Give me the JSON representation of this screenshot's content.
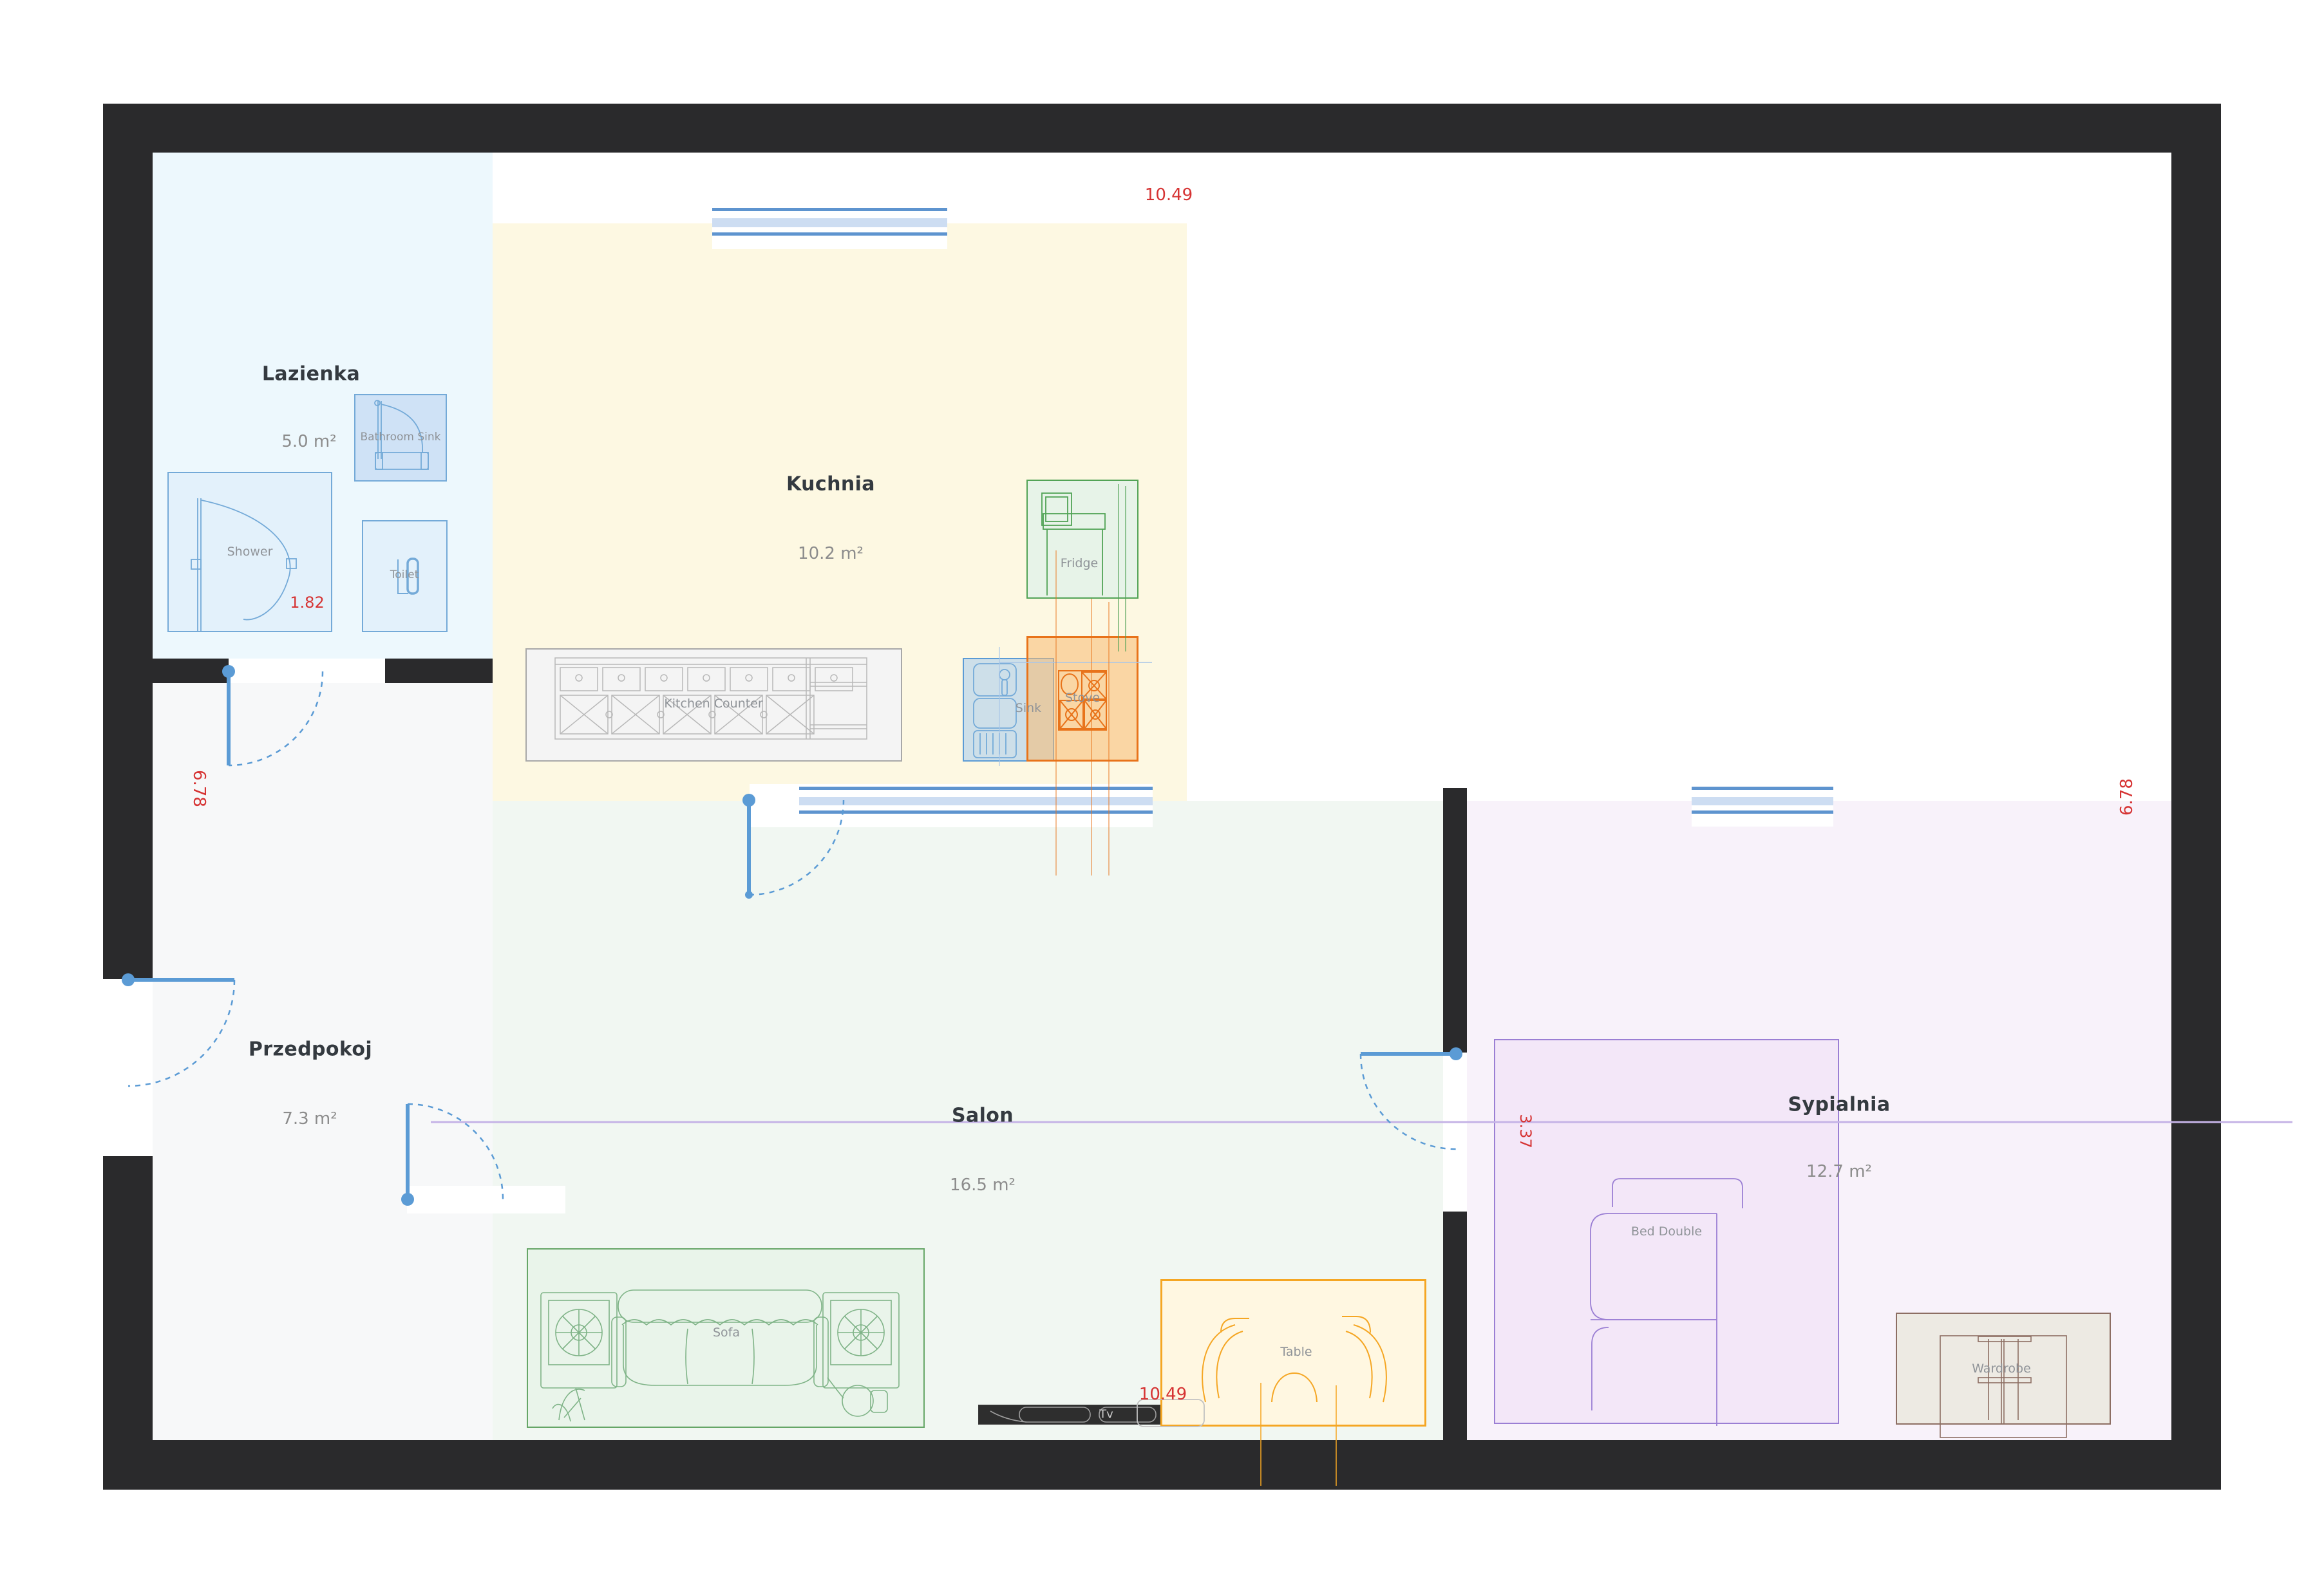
{
  "rooms": [
    {
      "id": "lazienka",
      "name": "Lazienka",
      "area": "5.0 m²"
    },
    {
      "id": "kuchnia",
      "name": "Kuchnia",
      "area": "10.2 m²"
    },
    {
      "id": "przedpokoj",
      "name": "Przedpokoj",
      "area": "7.3 m²"
    },
    {
      "id": "salon",
      "name": "Salon",
      "area": "16.5 m²"
    },
    {
      "id": "sypialnia",
      "name": "Sypialnia",
      "area": "12.7 m²"
    }
  ],
  "furniture": {
    "shower": "Shower",
    "bathroom_sink": "Bathroom Sink",
    "toilet": "Toilet",
    "fridge": "Fridge",
    "kitchen_counter": "Kitchen Counter",
    "sink": "Sink",
    "stove": "Stove",
    "sofa": "Sofa",
    "tv": "Tv",
    "table": "Table",
    "bed_double": "Bed Double",
    "wardrobe": "Wardrobe"
  },
  "dimensions": {
    "width_top": "10.49",
    "width_bottom": "10.49",
    "height_left": "6.78",
    "height_right": "6.78",
    "shower_width": "1.82",
    "bedroom_width": "3.37"
  },
  "colors": {
    "wall": "#2a2a2c",
    "dimension_text": "#d63333",
    "door": "#5b9bd5",
    "lazienka_fill": "#edf8fd",
    "kuchnia_fill": "#fdf8e2",
    "przedpokoj_fill": "#f7f8f9",
    "salon_fill": "#f1f7f2",
    "sypialnia_fill": "#f8f2fa"
  }
}
